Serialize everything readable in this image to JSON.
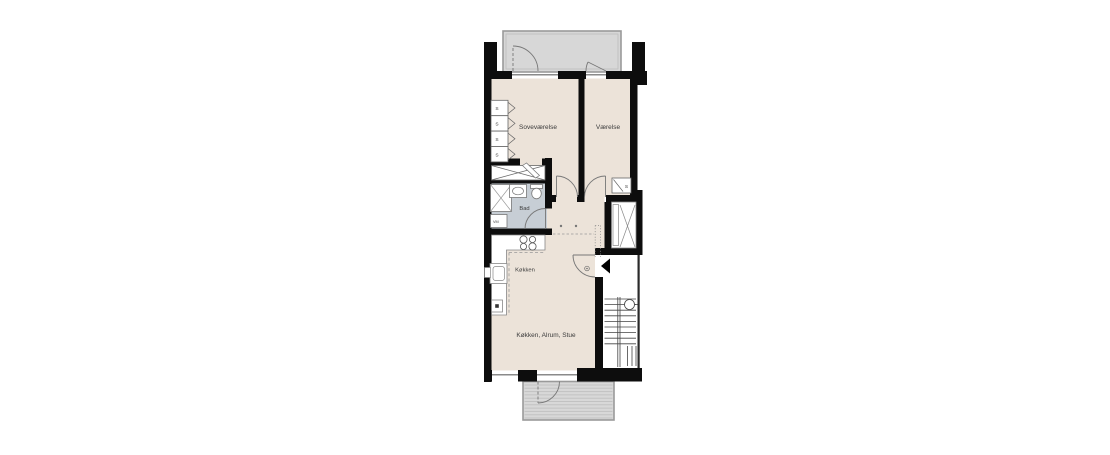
{
  "scene": {
    "type": "apartment-floor-plan",
    "language": "Danish",
    "background": "#ffffff"
  },
  "floorplan": {
    "rooms": [
      {
        "id": "sovevaerelse",
        "label": "Soveværelse"
      },
      {
        "id": "vaerelse",
        "label": "Værelse"
      },
      {
        "id": "bad",
        "label": "Bad"
      },
      {
        "id": "koekken",
        "label": "Køkken"
      },
      {
        "id": "koekken-alrum-stue",
        "label": "Køkken, Alrum, Stue"
      }
    ],
    "labels": {
      "wardrobe": "S",
      "washing_machine": "VM"
    },
    "features": [
      "balcony-top",
      "balcony-bottom",
      "elevator",
      "staircase",
      "entrance-arrow",
      "wardrobe-units",
      "closet-x",
      "shower",
      "bath-sink",
      "toilet",
      "stove-burners",
      "kitchen-sink"
    ],
    "colors": {
      "wall": "#0d0d0d",
      "floor": "#ece3d9",
      "bathroom_floor": "#c7ced5",
      "balcony": "#d7d7d7",
      "balcony_stripe": "#c2c2c2",
      "thin_line": "#777777",
      "label_text": "#3b3b3b"
    }
  }
}
